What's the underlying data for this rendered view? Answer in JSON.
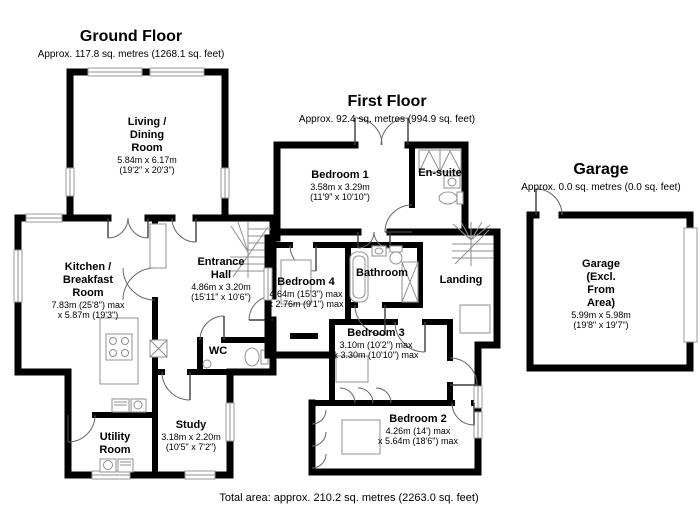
{
  "colors": {
    "walls": "#000000",
    "thin_lines": "#8f8f8f",
    "text": "#000000",
    "background": "#ffffff"
  },
  "footer": {
    "total_area": "Total area: approx. 210.2 sq. metres (2263.0 sq. feet)"
  },
  "ground_floor": {
    "title": "Ground Floor",
    "subtitle": "Approx. 117.8 sq. metres (1268.1 sq. feet)",
    "rooms": {
      "living_dining": {
        "name": "Living /\nDining\nRoom",
        "dim_metric": "5.84m x 6.17m",
        "dim_imperial": "(19'2\" x 20'3\")"
      },
      "kitchen": {
        "name": "Kitchen /\nBreakfast\nRoom",
        "dim_metric": "7.83m (25'8\") max",
        "dim_imperial": "x 5.87m (19'3\")"
      },
      "entrance_hall": {
        "name": "Entrance\nHall",
        "dim_metric": "4.86m x 3.20m",
        "dim_imperial": "(15'11\" x 10'6\")"
      },
      "wc": {
        "name": "WC"
      },
      "study": {
        "name": "Study",
        "dim_metric": "3.18m x 2.20m",
        "dim_imperial": "(10'5\" x 7'2\")"
      },
      "utility": {
        "name": "Utility\nRoom"
      }
    }
  },
  "first_floor": {
    "title": "First Floor",
    "subtitle": "Approx. 92.4 sq. metres (994.9 sq. feet)",
    "rooms": {
      "bedroom1": {
        "name": "Bedroom 1",
        "dim_metric": "3.58m x 3.29m",
        "dim_imperial": "(11'9\" x 10'10\")"
      },
      "ensuite": {
        "name": "En-suite"
      },
      "bedroom4": {
        "name": "Bedroom 4",
        "dim_metric": "4.64m (15'3\") max",
        "dim_imperial": "x 2.76m (9'1\") max"
      },
      "bathroom": {
        "name": "Bathroom"
      },
      "landing": {
        "name": "Landing"
      },
      "bedroom3": {
        "name": "Bedroom 3",
        "dim_metric": "3.10m (10'2\") max",
        "dim_imperial": "x 3.30m (10'10\") max"
      },
      "bedroom2": {
        "name": "Bedroom 2",
        "dim_metric": "4.26m (14') max",
        "dim_imperial": "x 5.64m (18'6\") max"
      }
    }
  },
  "garage": {
    "title": "Garage",
    "subtitle": "Approx. 0.0 sq. metres (0.0 sq. feet)",
    "rooms": {
      "garage_internal": {
        "name": "Garage\n(Excl.\nFrom\nArea)",
        "dim_metric": "5.99m x 5.98m",
        "dim_imperial": "(19'8\" x 19'7\")"
      }
    }
  }
}
